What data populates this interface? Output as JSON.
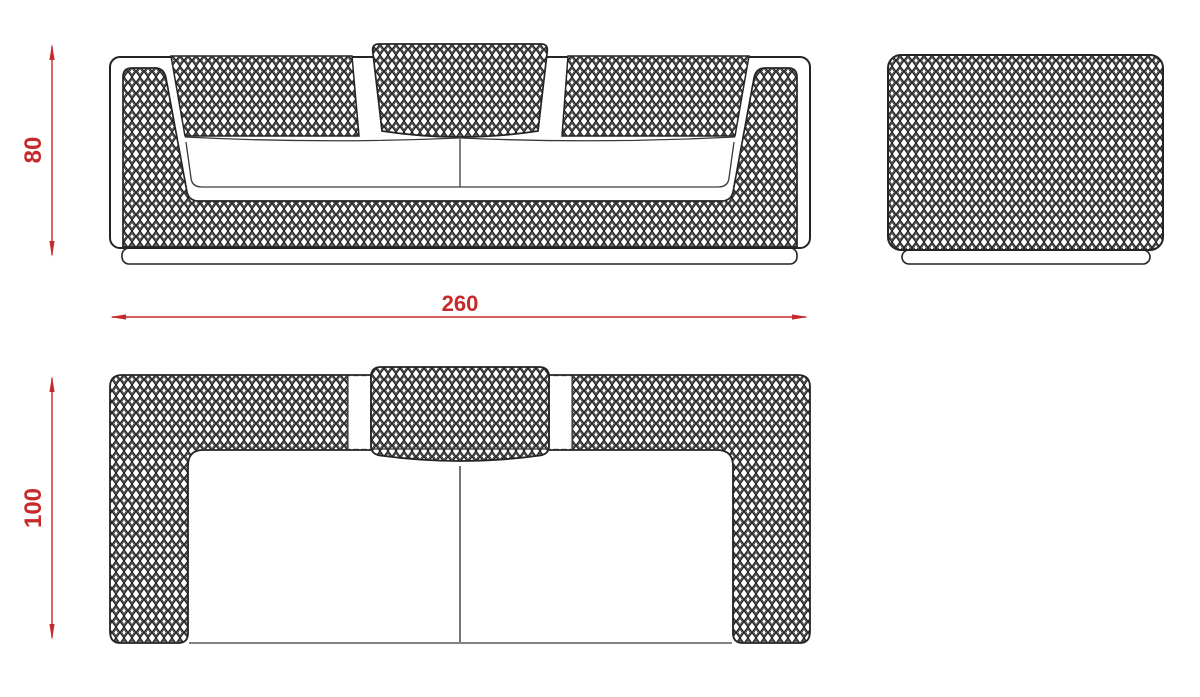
{
  "drawing": {
    "dimensions": {
      "front_height": "80",
      "overall_width": "260",
      "overall_depth": "100"
    },
    "colors": {
      "dimension": "#c62a2a",
      "outline": "#242424"
    }
  }
}
